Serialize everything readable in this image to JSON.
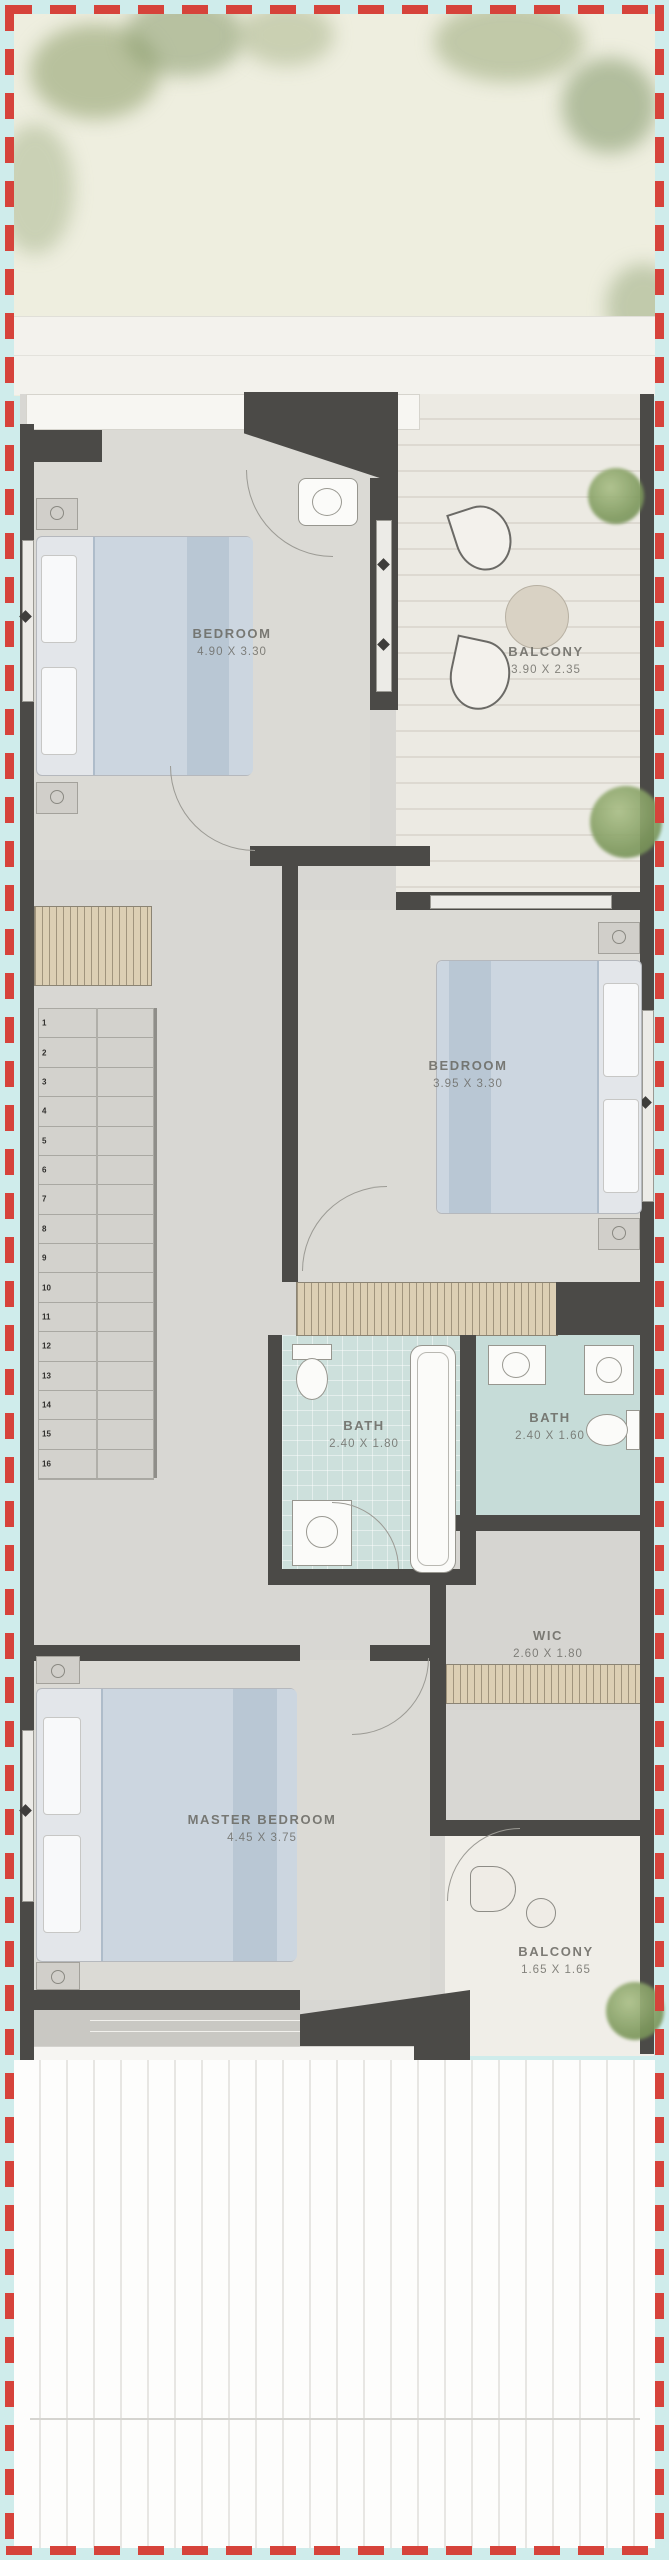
{
  "plan_title": "townhouse-upper-floor-plan",
  "rooms": {
    "bedroom1": {
      "name": "BEDROOM",
      "dims": "4.90 X 3.30"
    },
    "balcony1": {
      "name": "BALCONY",
      "dims": "3.90 X 2.35"
    },
    "bedroom2": {
      "name": "BEDROOM",
      "dims": "3.95 X 3.30"
    },
    "bath1": {
      "name": "BATH",
      "dims": "2.40 X 1.80"
    },
    "bath2": {
      "name": "BATH",
      "dims": "2.40 X 1.60"
    },
    "wic": {
      "name": "WIC",
      "dims": "2.60 X 1.80"
    },
    "master": {
      "name": "MASTER BEDROOM",
      "dims": "4.45 X 3.75"
    },
    "balcony2": {
      "name": "BALCONY",
      "dims": "1.65 X 1.65"
    }
  },
  "stairs": {
    "step_numbers": [
      1,
      2,
      3,
      4,
      5,
      6,
      7,
      8,
      9,
      10,
      11,
      12,
      13,
      14,
      15,
      16
    ]
  },
  "colors": {
    "boundary_dash": "#d6433b",
    "outer_background": "#cfeceb",
    "garden": "#eeeedf",
    "wall": "#4b4a47",
    "floor": "#d8d7d3",
    "bath_tile": "#cde0dc",
    "balcony_deck": "#eceae3",
    "bed_duvet": "#ccd6e0",
    "closet_hatch": "#dccfb4",
    "tree_green": "#7f9a5e",
    "label_text": "#696862"
  }
}
